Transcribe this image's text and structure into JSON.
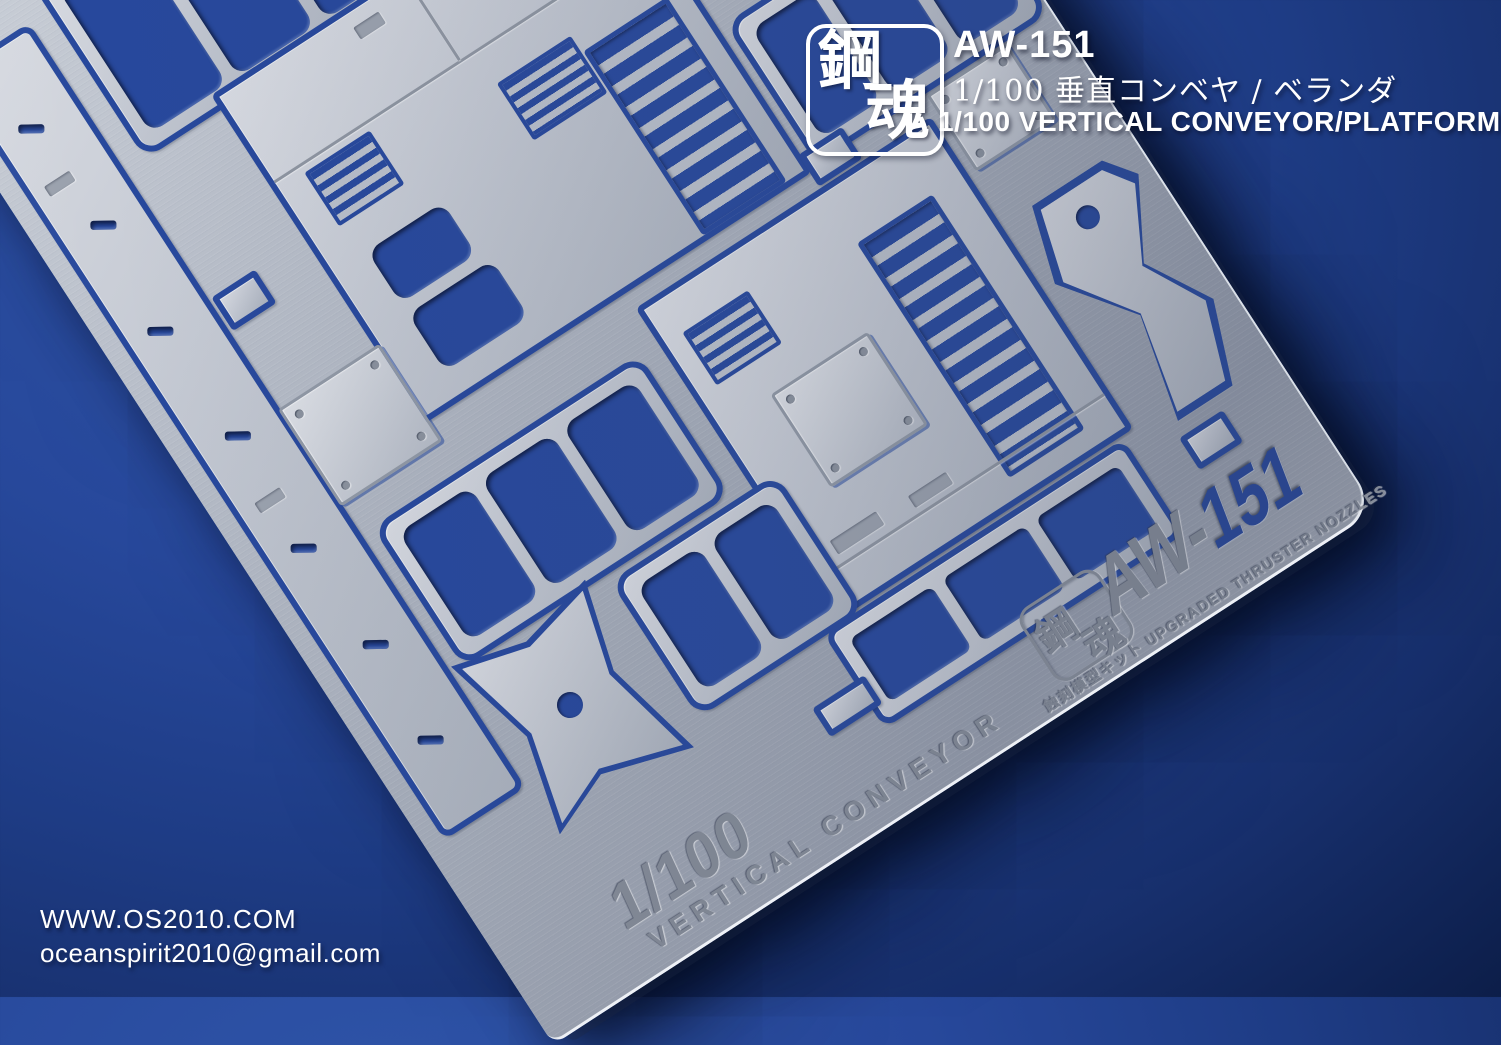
{
  "overlay": {
    "logo": {
      "char1": "鋼",
      "char2": "魂"
    },
    "product_code": "AW-151",
    "title_jp": "1/100 垂直コンベヤ / ベランダ",
    "title_en": "1/100 VERTICAL CONVEYOR/PLATFORM",
    "website": "WWW.OS2010.COM",
    "email": "oceanspirit2010@gmail.com"
  },
  "sheet": {
    "etched_scale": "1/100",
    "etched_product_name": "VERTICAL CONVEYOR",
    "etched_code_prefix": "AW-",
    "etched_code_number": "151",
    "etched_info_line": "蝕刻模型キット UPGRADED THRUSTER NOZZLES",
    "etched_logo": {
      "char1": "鋼",
      "char2": "魂"
    }
  },
  "colors": {
    "background_blue": "#1d3a7e",
    "cutout_blue": "#27489c",
    "metal_light": "#dde0e6",
    "metal_dark": "#959cab",
    "etch_gray": "#8b919d",
    "overlay_text": "#ffffff"
  }
}
